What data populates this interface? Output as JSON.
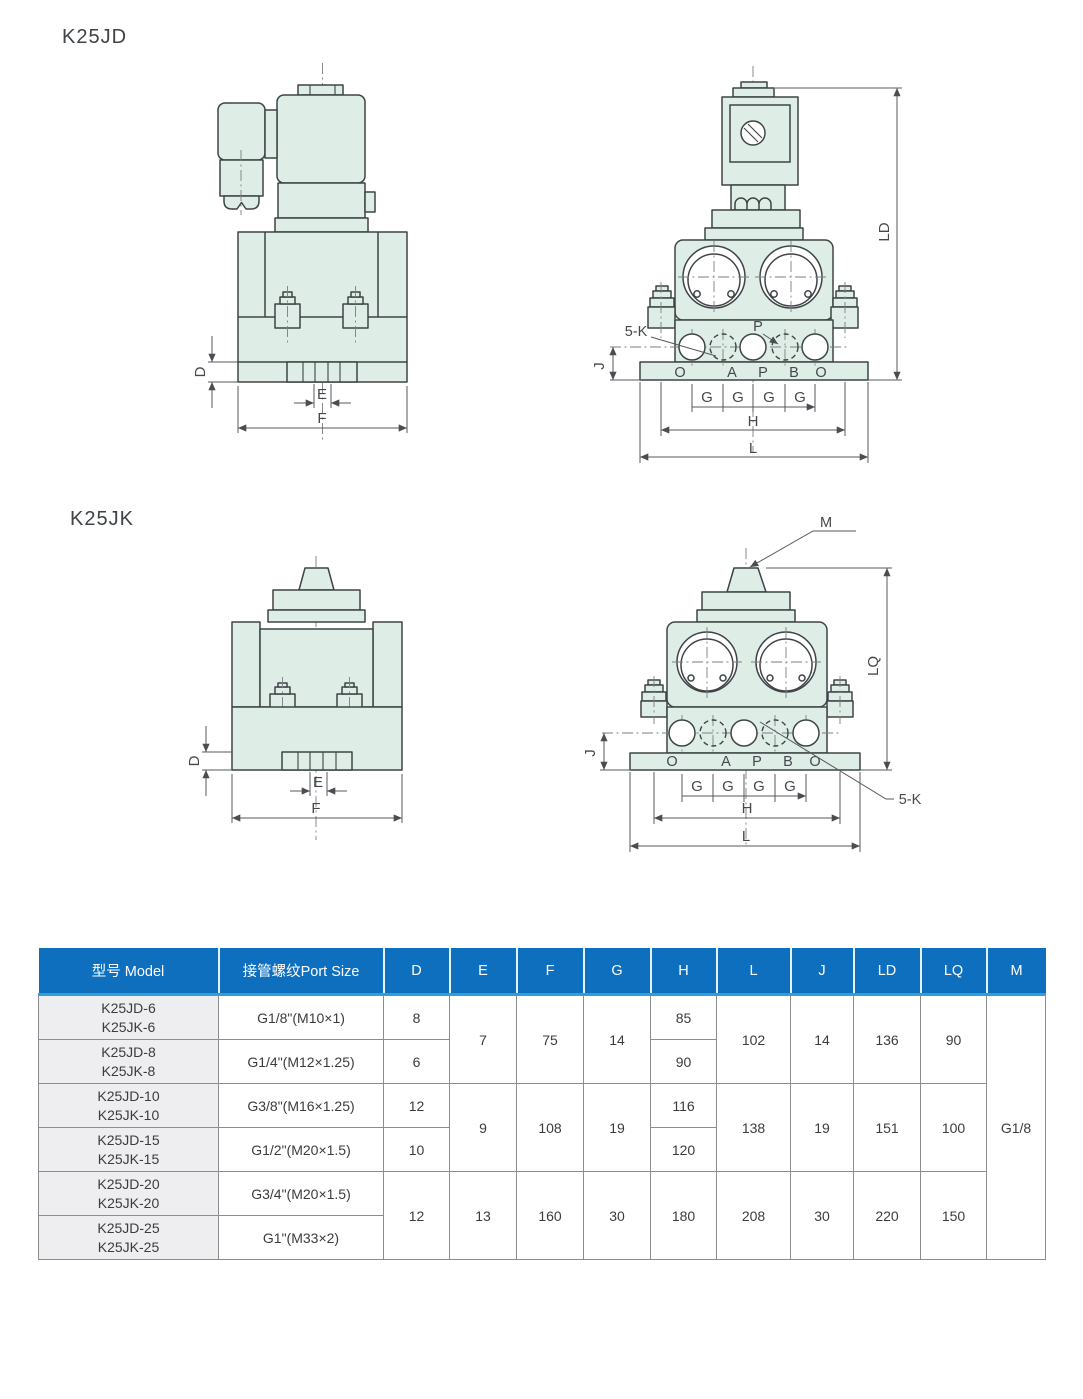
{
  "titles": {
    "k25jd": "K25JD",
    "k25jk": "K25JK"
  },
  "drawings": {
    "jd_side": {
      "d": "D",
      "e": "E",
      "f": "F"
    },
    "jd_front": {
      "ld": "LD",
      "j": "J",
      "h": "H",
      "l": "L",
      "g": [
        "G",
        "G",
        "G",
        "G"
      ],
      "five_k": "5-K",
      "p_label": "P",
      "ports": [
        "O",
        "A",
        "P",
        "B",
        "O"
      ]
    },
    "jk_side": {
      "d": "D",
      "e": "E",
      "f": "F"
    },
    "jk_front": {
      "m": "M",
      "lq": "LQ",
      "j": "J",
      "h": "H",
      "l": "L",
      "g": [
        "G",
        "G",
        "G",
        "G"
      ],
      "five_k": "5-K",
      "ports": [
        "O",
        "A",
        "P",
        "B",
        "O"
      ]
    }
  },
  "table": {
    "headers": [
      "型号 Model",
      "接管螺纹Port Size",
      "D",
      "E",
      "F",
      "G",
      "H",
      "L",
      "J",
      "LD",
      "LQ",
      "M"
    ],
    "m_value": "G1/8",
    "rows": [
      {
        "models": [
          "K25JD-6",
          "K25JK-6"
        ],
        "port": "G1/8\"(M10×1)",
        "D": "8",
        "H": "85"
      },
      {
        "models": [
          "K25JD-8",
          "K25JK-8"
        ],
        "port": "G1/4\"(M12×1.25)",
        "D": "6",
        "H": "90"
      },
      {
        "models": [
          "K25JD-10",
          "K25JK-10"
        ],
        "port": "G3/8\"(M16×1.25)",
        "D": "12",
        "H": "116"
      },
      {
        "models": [
          "K25JD-15",
          "K25JK-15"
        ],
        "port": "G1/2\"(M20×1.5)",
        "D": "10",
        "H": "120"
      },
      {
        "models": [
          "K25JD-20",
          "K25JK-20"
        ],
        "port": "G3/4\"(M20×1.5)"
      },
      {
        "models": [
          "K25JD-25",
          "K25JK-25"
        ],
        "port": "G1\"(M33×2)"
      }
    ],
    "groups": [
      {
        "E": "7",
        "F": "75",
        "G": "14",
        "L": "102",
        "J": "14",
        "LD": "136",
        "LQ": "90"
      },
      {
        "E": "9",
        "F": "108",
        "G": "19",
        "L": "138",
        "J": "19",
        "LD": "151",
        "LQ": "100"
      },
      {
        "D": "12",
        "E": "13",
        "F": "160",
        "G": "30",
        "H": "180",
        "L": "208",
        "J": "30",
        "LD": "220",
        "LQ": "150"
      }
    ]
  },
  "colors": {
    "header_blue": "#0e6fbe",
    "header_strip": "#2f9fd7",
    "drawing_fill": "#deede6",
    "row_shade": "#eeeef0"
  }
}
